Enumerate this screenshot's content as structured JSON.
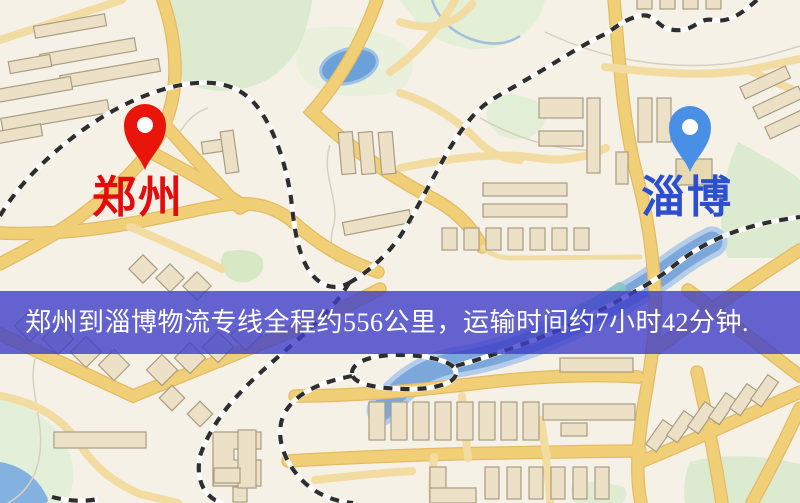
{
  "page_type": "logistics-route-map-image",
  "origin_marker": {
    "city": "郑州",
    "pin_color": "#e8150b",
    "label_color": "#e30b0b"
  },
  "destination_marker": {
    "city": "淄博",
    "pin_color": "#4a8fe6",
    "label_color": "#2b4fd0"
  },
  "banner": {
    "text": "郑州到淄博物流专线全程约556公里，运输时间约7小时42分钟.",
    "background_color": "#3e3ec8",
    "text_color": "#ffffff",
    "route_distance": "约556公里",
    "route_duration": "约7小时42分钟"
  },
  "map_colors": {
    "background": "#f6f1e6",
    "road_major": "#f1cf77",
    "road_minor": "#f2dca2",
    "building": "#ece1c6",
    "park": "#dcead0",
    "water": "#7ba7da",
    "railway": "#2e2e2e"
  }
}
